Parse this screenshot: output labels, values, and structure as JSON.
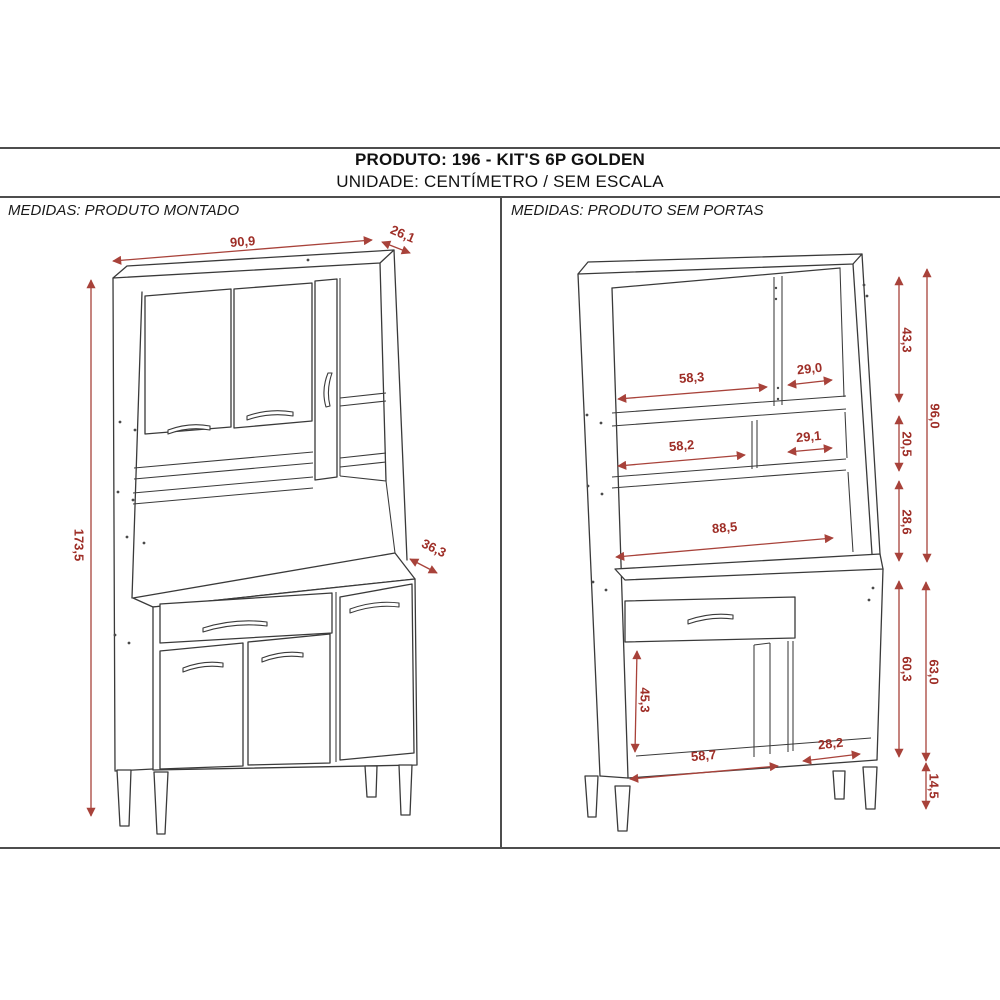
{
  "title": {
    "line1": "PRODUTO: 196 - KIT'S 6P GOLDEN",
    "line2": "UNIDADE: CENTÍMETRO / SEM ESCALA"
  },
  "unit": "centímetro",
  "scale_note": "sem escala",
  "colors": {
    "dimension": "#9e2e27",
    "line_art": "#3a3a3a",
    "frame": "#4d4d4d"
  },
  "panels": {
    "left": {
      "header": "MEDIDAS: PRODUTO MONTADO",
      "dimensions": {
        "width": "90,9",
        "top_depth": "26,1",
        "height": "173,5",
        "base_depth": "36,3"
      }
    },
    "right": {
      "header": "MEDIDAS: PRODUTO SEM PORTAS",
      "dimensions": {
        "top_left_opening": "58,3",
        "top_right_opening": "29,0",
        "top_section_height": "43,3",
        "hutch_height": "96,0",
        "shelf_left_opening": "58,2",
        "shelf_right_opening": "29,1",
        "shelf_section_height": "20,5",
        "niche_height": "28,6",
        "counter_width": "88,5",
        "base_opening_height": "45,3",
        "base_interior_height": "60,3",
        "base_height": "63,0",
        "base_left_opening": "58,7",
        "base_right_opening": "28,2",
        "leg_height": "14,5"
      }
    }
  }
}
